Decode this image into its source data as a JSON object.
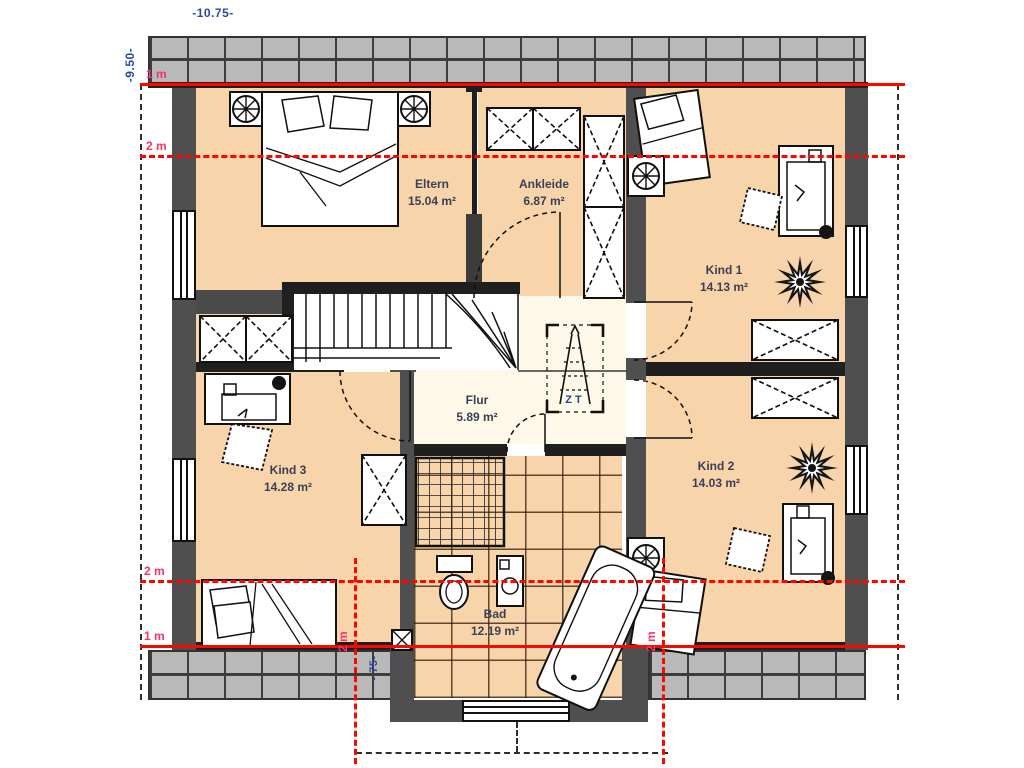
{
  "plan": {
    "title_dim_width": "-10.75-",
    "title_dim_height": "-9.50-",
    "dim_dormer": "-.75-",
    "marks": {
      "top_1m": "1 m",
      "top_2m": "2 m",
      "bottom_2m": "2 m",
      "bottom_1m": "1 m",
      "dormer_left_2m": "2 m",
      "dormer_right_2m": "2 m"
    },
    "rooms": {
      "eltern": {
        "name": "Eltern",
        "area": "15.04 m²"
      },
      "ankleide": {
        "name": "Ankleide",
        "area": "6.87 m²"
      },
      "kind1": {
        "name": "Kind 1",
        "area": "14.13 m²"
      },
      "flur": {
        "name": "Flur",
        "area": "5.89 m²"
      },
      "kind3": {
        "name": "Kind 3",
        "area": "14.28 m²"
      },
      "kind2": {
        "name": "Kind 2",
        "area": "14.03 m²"
      },
      "bad": {
        "name": "Bad",
        "area": "12.19 m²"
      }
    },
    "attic_label": "ZT",
    "colors": {
      "floor": "#f8d4ab",
      "flur_floor": "#fdf8e8",
      "wall_dark": "#1f1f1f",
      "wall_gray": "#4f4f4f",
      "roof_band": "#b9b9b9",
      "red_line": "#fb0700",
      "red_label": "#f4356a",
      "dim_text": "#2c49a0",
      "room_label": "#3a3f55"
    }
  }
}
